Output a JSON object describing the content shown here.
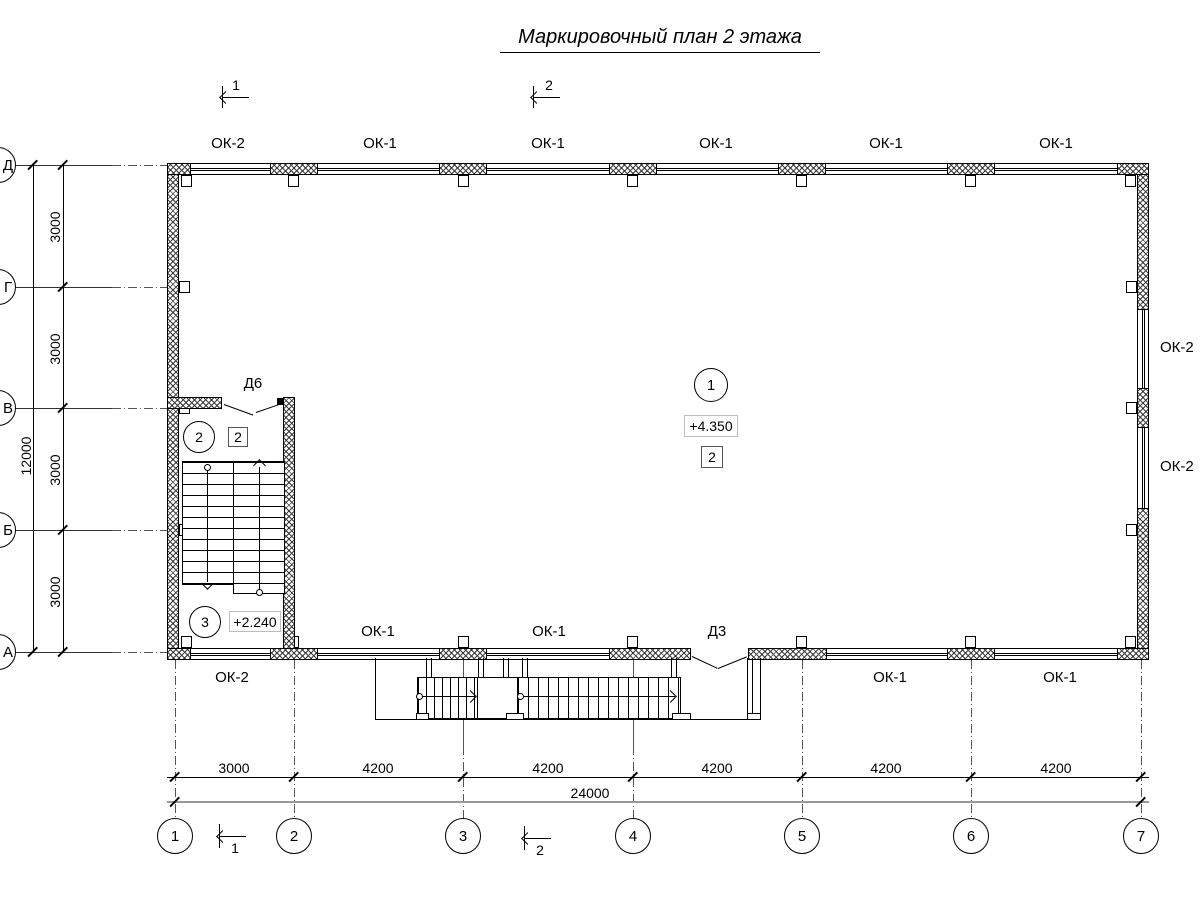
{
  "title": "Маркировочный план 2 этажа",
  "sections": {
    "s1": "1",
    "s2": "2"
  },
  "axes": {
    "rows": [
      "Д",
      "Г",
      "В",
      "Б",
      "А"
    ],
    "cols": [
      "1",
      "2",
      "3",
      "4",
      "5",
      "6",
      "7"
    ]
  },
  "dims": {
    "left": [
      "3000",
      "3000",
      "3000",
      "3000"
    ],
    "left_total": "12000",
    "bottom": [
      "3000",
      "4200",
      "4200",
      "4200",
      "4200",
      "4200"
    ],
    "bottom_total": "24000"
  },
  "windows": {
    "top": [
      "ОК-2",
      "ОК-1",
      "ОК-1",
      "ОК-1",
      "ОК-1",
      "ОК-1"
    ],
    "right": [
      "ОК-2",
      "ОК-2"
    ],
    "bottom": [
      "ОК-2",
      "ОК-1",
      "ОК-1",
      "ОК-1",
      "ОК-1"
    ]
  },
  "doors": {
    "d6": "Д6",
    "d3": "Д3"
  },
  "rooms": {
    "r1": {
      "number": "1",
      "elevation": "+4.350",
      "grade": "2"
    },
    "r2": {
      "number": "2",
      "grade": "2"
    },
    "r3": {
      "number": "3",
      "elevation": "+2.240"
    }
  }
}
